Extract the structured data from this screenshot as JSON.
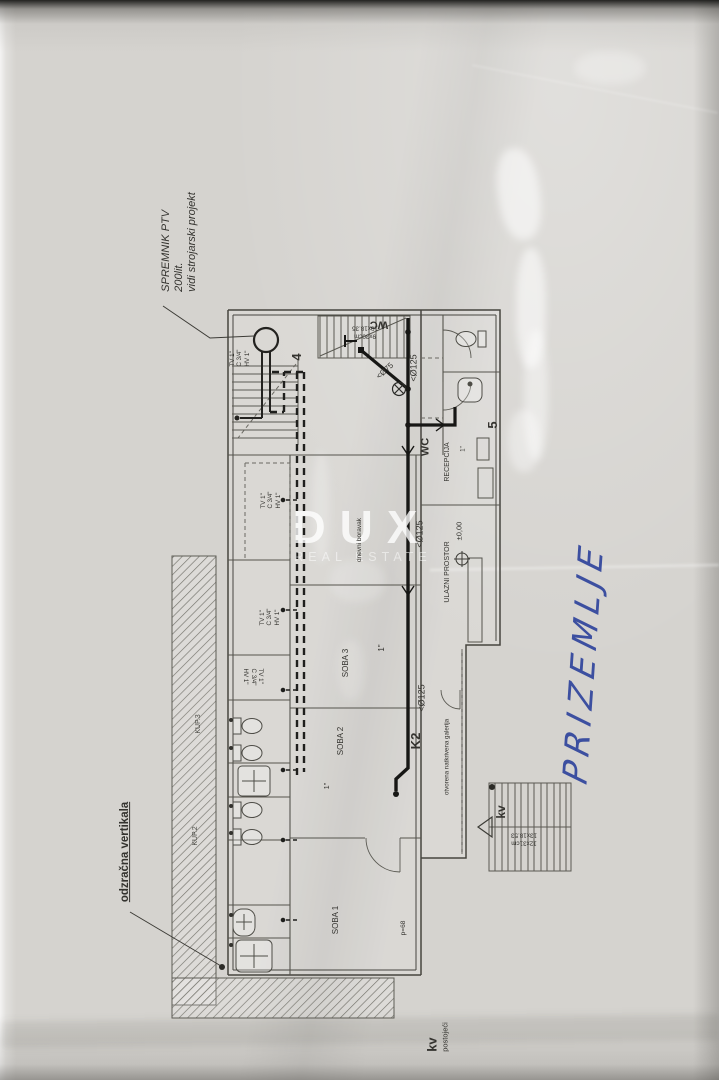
{
  "handwriting": {
    "title": "PRIZEMLJE"
  },
  "watermark": {
    "brand": "DUX",
    "subtitle": "REAL ESTATE"
  },
  "annotations": {
    "spremnik_line1": "SPREMNIK PTV",
    "spremnik_line2": "200lit.",
    "spremnik_line3": "vidi strojarski projekt",
    "odzracna": "odzračna vertikala",
    "kv_bold": "kv",
    "kv_sub": "postojeći"
  },
  "rooms": {
    "soba1": "SOBA 1",
    "soba2": "SOBA 2",
    "soba3": "SOBA 3",
    "dnevni": "dnevni boravak",
    "recepcija": "RECEPCIJA",
    "ulazni": "ULAZNI PROSTOR",
    "level": "±0,00",
    "galerija": "otvorena natkrivena galerija",
    "wc_top": "WC",
    "wc_mid": "WC",
    "kup3": "KUP.3",
    "kup2": "KUP.2",
    "kv_stairs": "kv"
  },
  "pipes": {
    "d125": "<Ø125",
    "d75": "<Ø75",
    "k2": "K2",
    "tv": "TV 1\"",
    "c": "C 3/4\"",
    "hv": "HV 1\"",
    "one_inch": "1\"",
    "p68": "p=68"
  },
  "marks": {
    "n4": "4",
    "n5": "5"
  },
  "stairs": {
    "upper_line1": "9x30cm",
    "upper_line2": "10x18.35",
    "lower_line1": "12x31cm",
    "lower_line2": "13x18.53"
  }
}
